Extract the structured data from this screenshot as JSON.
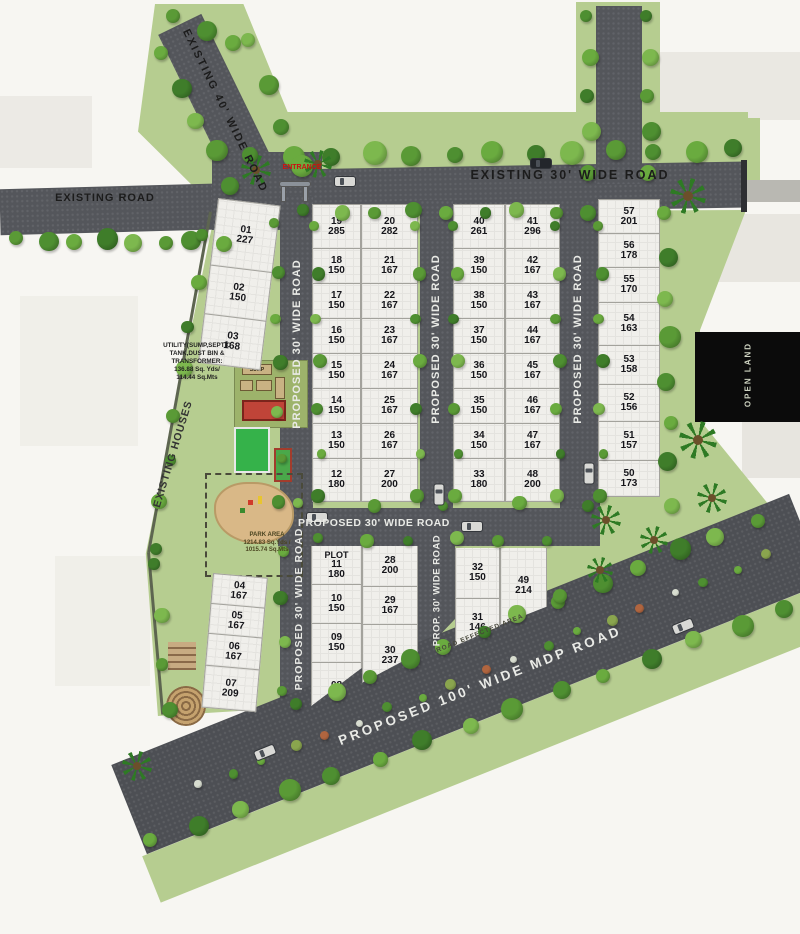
{
  "roads": {
    "existing_road": "EXISTING ROAD",
    "existing_40": "EXISTING 40' WIDE ROAD",
    "existing_30": "EXISTING 30' WIDE ROAD",
    "proposed_30": "PROPOSED 30' WIDE ROAD",
    "prop_30": "PROP. 30' WIDE ROAD",
    "mdp_100": "PROPOSED 100' WIDE MDP ROAD",
    "road_effected": "ROAD EFFECTED AREA"
  },
  "labels": {
    "existing_houses": "EXISTING HOUSES",
    "entrance": "ENTRANCE",
    "open_land": "OPEN LAND",
    "sump": "SUMP",
    "utility_note": "UTILITY(SUMP,SEPTIC\nTANK,DUST BIN &\nTRANSFORMER:\n136.88 Sq. Yds/\n114.44 Sq.Mts",
    "park_note": "PARK AREA\n1214.83 Sq.Yds /\n1015.74 Sq.Mts"
  },
  "blocks": {
    "c01": [
      {
        "no": "01",
        "area": "227"
      },
      {
        "no": "02",
        "area": "150"
      },
      {
        "no": "03",
        "area": "168"
      }
    ],
    "c04": [
      {
        "no": "04",
        "area": "167"
      },
      {
        "no": "05",
        "area": "167"
      },
      {
        "no": "06",
        "area": "167"
      },
      {
        "no": "07",
        "area": "209"
      }
    ],
    "c19": [
      {
        "no": "19",
        "area": "285"
      },
      {
        "no": "18",
        "area": "150"
      },
      {
        "no": "17",
        "area": "150"
      },
      {
        "no": "16",
        "area": "150"
      },
      {
        "no": "15",
        "area": "150"
      },
      {
        "no": "14",
        "area": "150"
      },
      {
        "no": "13",
        "area": "150"
      },
      {
        "no": "12",
        "area": "180"
      }
    ],
    "c20": [
      {
        "no": "20",
        "area": "282"
      },
      {
        "no": "21",
        "area": "167"
      },
      {
        "no": "22",
        "area": "167"
      },
      {
        "no": "23",
        "area": "167"
      },
      {
        "no": "24",
        "area": "167"
      },
      {
        "no": "25",
        "area": "167"
      },
      {
        "no": "26",
        "area": "167"
      },
      {
        "no": "27",
        "area": "200"
      }
    ],
    "c40": [
      {
        "no": "40",
        "area": "261"
      },
      {
        "no": "39",
        "area": "150"
      },
      {
        "no": "38",
        "area": "150"
      },
      {
        "no": "37",
        "area": "150"
      },
      {
        "no": "36",
        "area": "150"
      },
      {
        "no": "35",
        "area": "150"
      },
      {
        "no": "34",
        "area": "150"
      },
      {
        "no": "33",
        "area": "180"
      }
    ],
    "c41": [
      {
        "no": "41",
        "area": "296"
      },
      {
        "no": "42",
        "area": "167"
      },
      {
        "no": "43",
        "area": "167"
      },
      {
        "no": "44",
        "area": "167"
      },
      {
        "no": "45",
        "area": "167"
      },
      {
        "no": "46",
        "area": "167"
      },
      {
        "no": "47",
        "area": "167"
      },
      {
        "no": "48",
        "area": "200"
      }
    ],
    "c57": [
      {
        "no": "57",
        "area": "201"
      },
      {
        "no": "56",
        "area": "178"
      },
      {
        "no": "55",
        "area": "170"
      },
      {
        "no": "54",
        "area": "163"
      },
      {
        "no": "53",
        "area": "158"
      },
      {
        "no": "52",
        "area": "156"
      },
      {
        "no": "51",
        "area": "157"
      },
      {
        "no": "50",
        "area": "173"
      }
    ],
    "c11": [
      {
        "prefix": "PLOT",
        "no": "11",
        "area": "180"
      },
      {
        "no": "10",
        "area": "150"
      },
      {
        "no": "09",
        "area": "150"
      },
      {
        "no": "08",
        "area": "154"
      }
    ],
    "c28": [
      {
        "no": "28",
        "area": "200"
      },
      {
        "no": "29",
        "area": "167"
      },
      {
        "no": "30",
        "area": "237"
      }
    ],
    "c32": [
      {
        "no": "32",
        "area": "150"
      },
      {
        "no": "31",
        "area": "146"
      }
    ],
    "c49": [
      {
        "no": "49",
        "area": "214"
      }
    ]
  },
  "colors": {
    "land": "#b6cd90",
    "road": "#54565b",
    "plot": "#f0efeb",
    "accent_red": "#cc1111"
  }
}
